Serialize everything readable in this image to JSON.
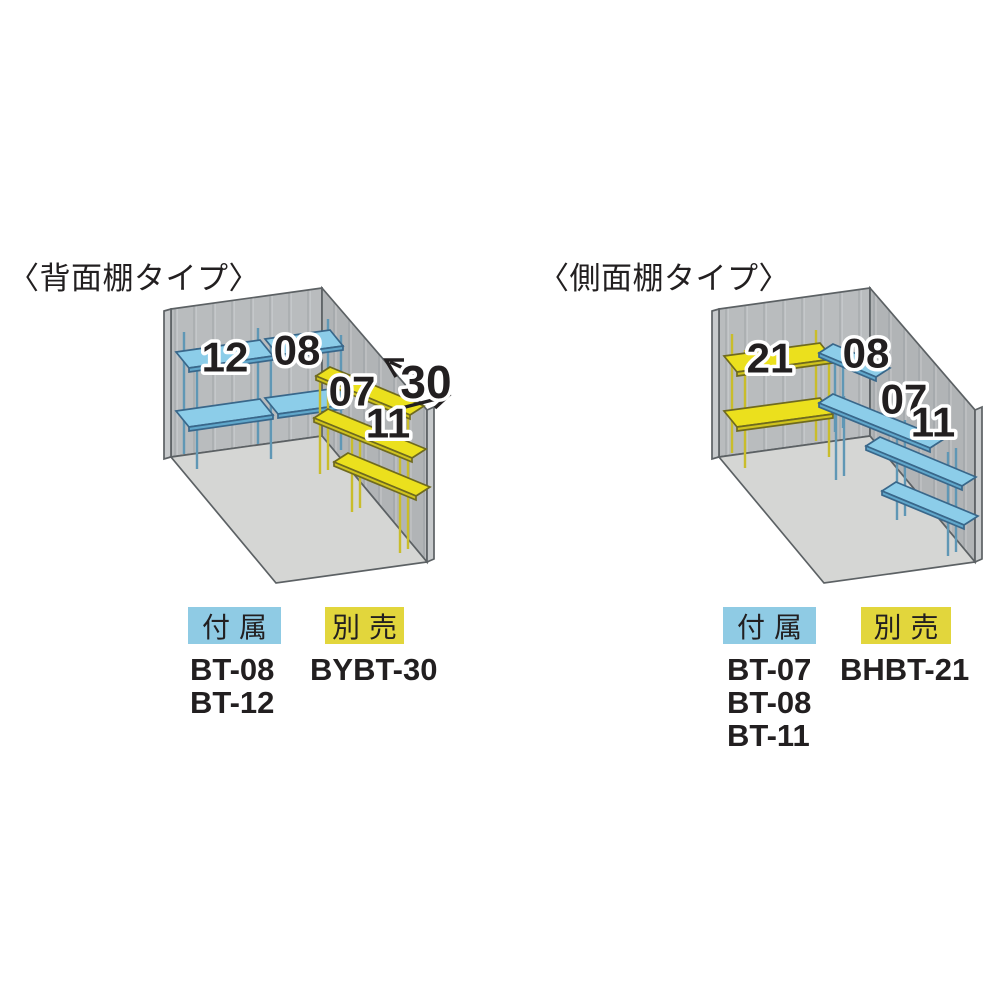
{
  "colors": {
    "included_blue": "#8CCDE9",
    "optional_yellow": "#EBE01D",
    "badge_blue": "#8FCBE4",
    "badge_yellow": "#E2D63C",
    "wall_gray": "#B9BCBE",
    "floor_gray": "#D5D6D4",
    "text": "#221F20"
  },
  "diagrams": [
    {
      "title": "〈背面棚タイプ〉",
      "board_labels": {
        "b12": "12",
        "b08": "08",
        "b07": "07",
        "b11": "11"
      },
      "dimension_label": "30",
      "legend": {
        "included": {
          "badge": "付属",
          "codes": [
            "BT-08",
            "BT-12"
          ]
        },
        "optional": {
          "badge": "別売",
          "codes": [
            "BYBT-30"
          ]
        }
      }
    },
    {
      "title": "〈側面棚タイプ〉",
      "board_labels": {
        "b21": "21",
        "b08": "08",
        "b07": "07",
        "b11": "11"
      },
      "legend": {
        "included": {
          "badge": "付属",
          "codes": [
            "BT-07",
            "BT-08",
            "BT-11"
          ]
        },
        "optional": {
          "badge": "別売",
          "codes": [
            "BHBT-21"
          ]
        }
      }
    }
  ]
}
